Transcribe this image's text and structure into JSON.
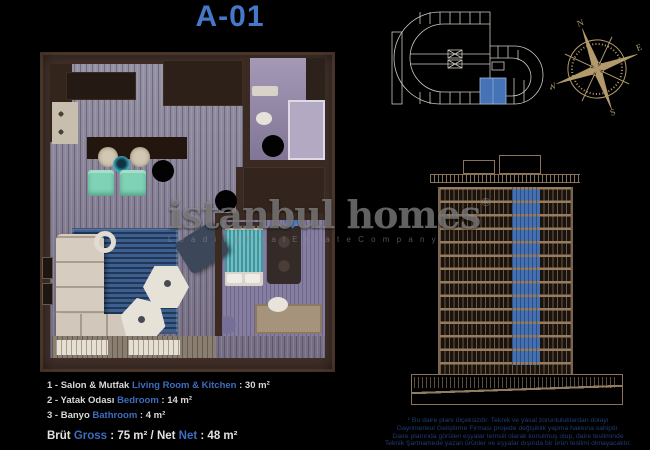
{
  "title": "A-01",
  "watermark": {
    "brand": "istanbul homes",
    "reg": "®",
    "tagline": "L e a d i n g   R e a l   E s t a t e   C o m p a n y"
  },
  "legend": {
    "items": [
      {
        "pre": "1 - Salon & Mutfak ",
        "en": "Living Room & Kitchen",
        "post": " : 30 m²"
      },
      {
        "pre": "2 - Yatak Odası ",
        "en": "Bedroom",
        "post": " : 14 m²"
      },
      {
        "pre": "3 - Banyo ",
        "en": "Bathroom",
        "post": " : 4 m²"
      }
    ],
    "total": {
      "pre": "Brüt ",
      "gross": "Gross",
      "mid": " : 75 m² / Net ",
      "net": "Net",
      "post": " : 48 m²"
    }
  },
  "disclaimer": {
    "lines": [
      "* Bu daire planı ölçeksizdir. Teknik ve yasal zorunluluklardan dolayı",
      "Gayrimenkul Geliştirme Firması projede değişiklik yapma hakkına sahiptir.",
      "Daire planında görülen eşyalar temsili olarak konulmuş olup, daire tesliminde",
      "Teknik Şartnamede yazan ürünler ve eşyalar dışında bir ürün teslimi olmayacaktır."
    ]
  },
  "compass": {
    "n": "N",
    "e": "E",
    "s": "S",
    "w": "W"
  },
  "plan": {
    "markers": [
      "1",
      "2",
      "3"
    ]
  },
  "colors": {
    "accent_blue": "#4478c8",
    "legend_blue": "#3e6cc0",
    "disclaimer_blue": "#1f3c74",
    "compass_tan": "#b39a6d",
    "elevation_tan": "#9a8265",
    "keyplan_line": "#cfc9bf",
    "highlight_unit": "#4673b5"
  }
}
